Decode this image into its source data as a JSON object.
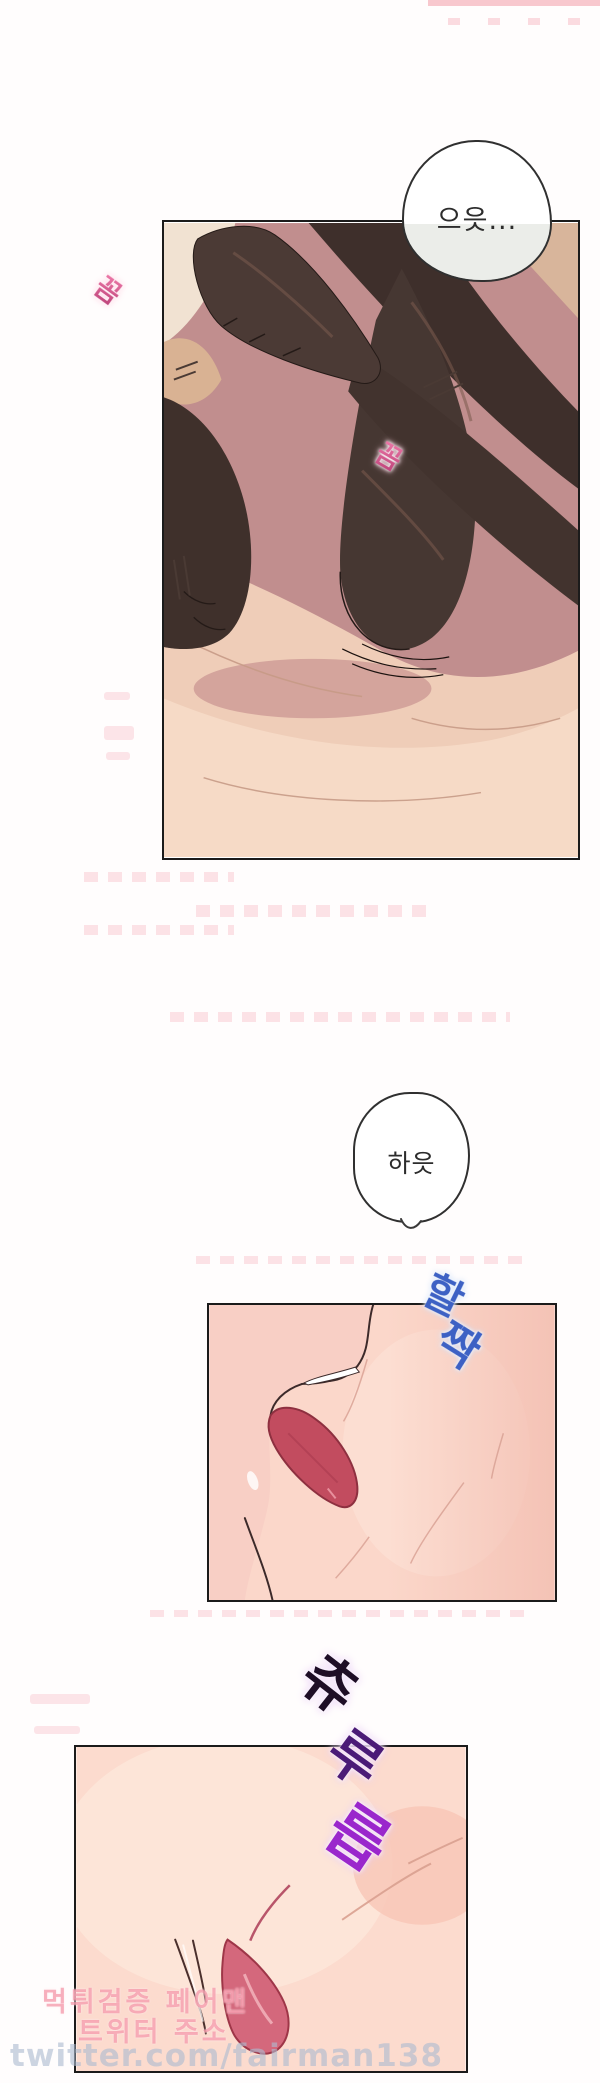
{
  "page": {
    "kind": "webtoon-comic-page",
    "background": "#fffdfd",
    "panel_border_color": "#1b1b1b"
  },
  "bubbles": {
    "scream": {
      "text": "으읏..."
    },
    "gasp": {
      "text": "하읏"
    }
  },
  "sfx": {
    "wiggle1": {
      "text": "꼼지락",
      "color_from": "#f07cab",
      "color_to": "#8e2f78"
    },
    "wiggle2": {
      "text": "꼼지락",
      "color_from": "#f07cab",
      "color_to": "#8e2f78"
    },
    "lick": {
      "text": "할짝",
      "color": "#3d61c4"
    },
    "slurp": {
      "text": "츄루릅",
      "color_top": "#1e0e26",
      "color_mid": "#4b1b77",
      "color_bottom": "#9a27cc"
    }
  },
  "watermark": {
    "line1": "먹튀검증 페어맨",
    "line2": "트위터 주소",
    "url": "twitter.com/fairman138",
    "pink": "#f07a90",
    "url_color": "#acbbd0"
  },
  "panels": [
    {
      "id": "panel-1",
      "depicts": "legs in dark stockings crossed on pink bed sheets"
    },
    {
      "id": "panel-2",
      "depicts": "close-up profile with tongue licking skin"
    },
    {
      "id": "panel-3",
      "depicts": "close-up of skin with crease and red fold"
    }
  ],
  "colors": {
    "bedding_mauve": "#c18e8e",
    "sheet_cream": "#efcdb8",
    "stocking_dark": "#42332e",
    "skin_light": "#fbd7ca",
    "tongue_red": "#c24c5f",
    "fold_red": "#d4687c"
  }
}
